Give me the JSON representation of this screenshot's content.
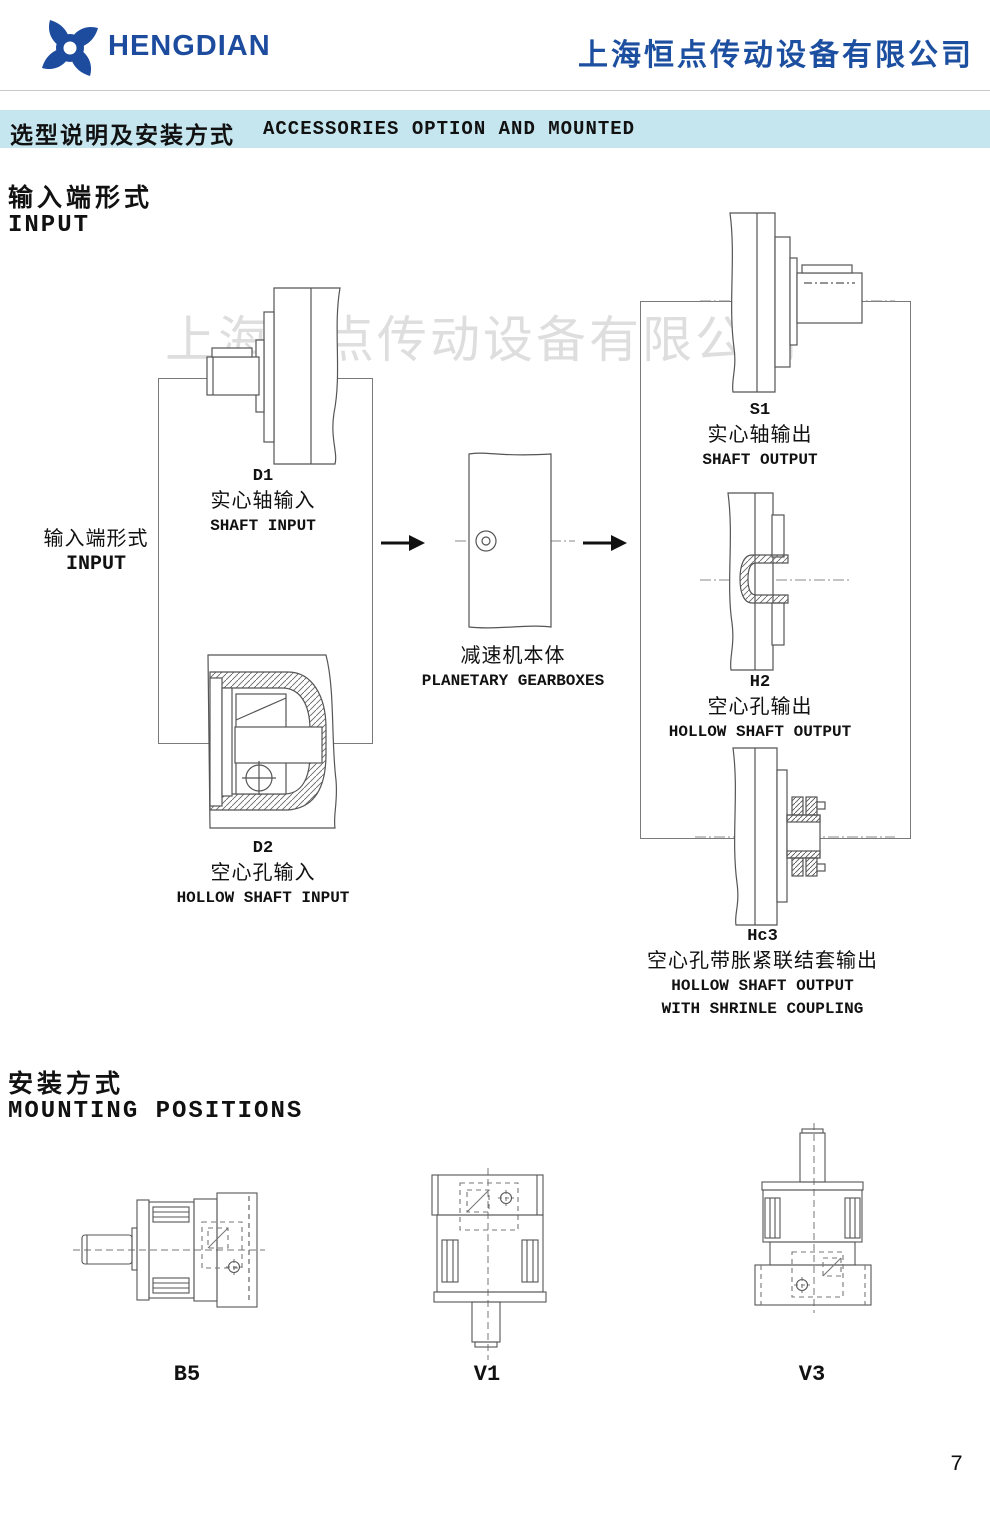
{
  "header": {
    "logo_text": "HENGDIAN",
    "company_name": "上海恒点传动设备有限公司"
  },
  "section_bar": {
    "title_zh": "选型说明及安装方式",
    "title_en": "ACCESSORIES OPTION AND MOUNTED"
  },
  "watermark_text": "上海恒点传动设备有限公司",
  "input_section": {
    "heading_zh": "输入端形式",
    "heading_en": "INPUT",
    "side_label_zh": "输入端形式",
    "side_label_en": "INPUT",
    "inputs": [
      {
        "code": "D1",
        "name_zh": "实心轴输入",
        "name_en": "SHAFT INPUT"
      },
      {
        "code": "D2",
        "name_zh": "空心孔输入",
        "name_en": "HOLLOW SHAFT INPUT"
      }
    ],
    "gearbox": {
      "name_zh": "减速机本体",
      "name_en": "PLANETARY GEARBOXES"
    },
    "outputs": [
      {
        "code": "S1",
        "name_zh": "实心轴输出",
        "name_en": "SHAFT OUTPUT"
      },
      {
        "code": "H2",
        "name_zh": "空心孔输出",
        "name_en": "HOLLOW SHAFT OUTPUT"
      },
      {
        "code": "Hc3",
        "name_zh": "空心孔带胀紧联结套输出",
        "name_en": "HOLLOW SHAFT OUTPUT",
        "name_en2": "WITH SHRINLE COUPLING"
      }
    ]
  },
  "mounting_section": {
    "heading_zh": "安装方式",
    "heading_en": "MOUNTING POSITIONS",
    "positions": [
      {
        "code": "B5"
      },
      {
        "code": "V1"
      },
      {
        "code": "V3"
      }
    ]
  },
  "page_number": "7",
  "colors": {
    "brand_blue": "#1d4c9f",
    "section_bar_bg": "#c5e6ef",
    "watermark_gray": "#dedede",
    "line_gray": "#4d4d4d"
  }
}
